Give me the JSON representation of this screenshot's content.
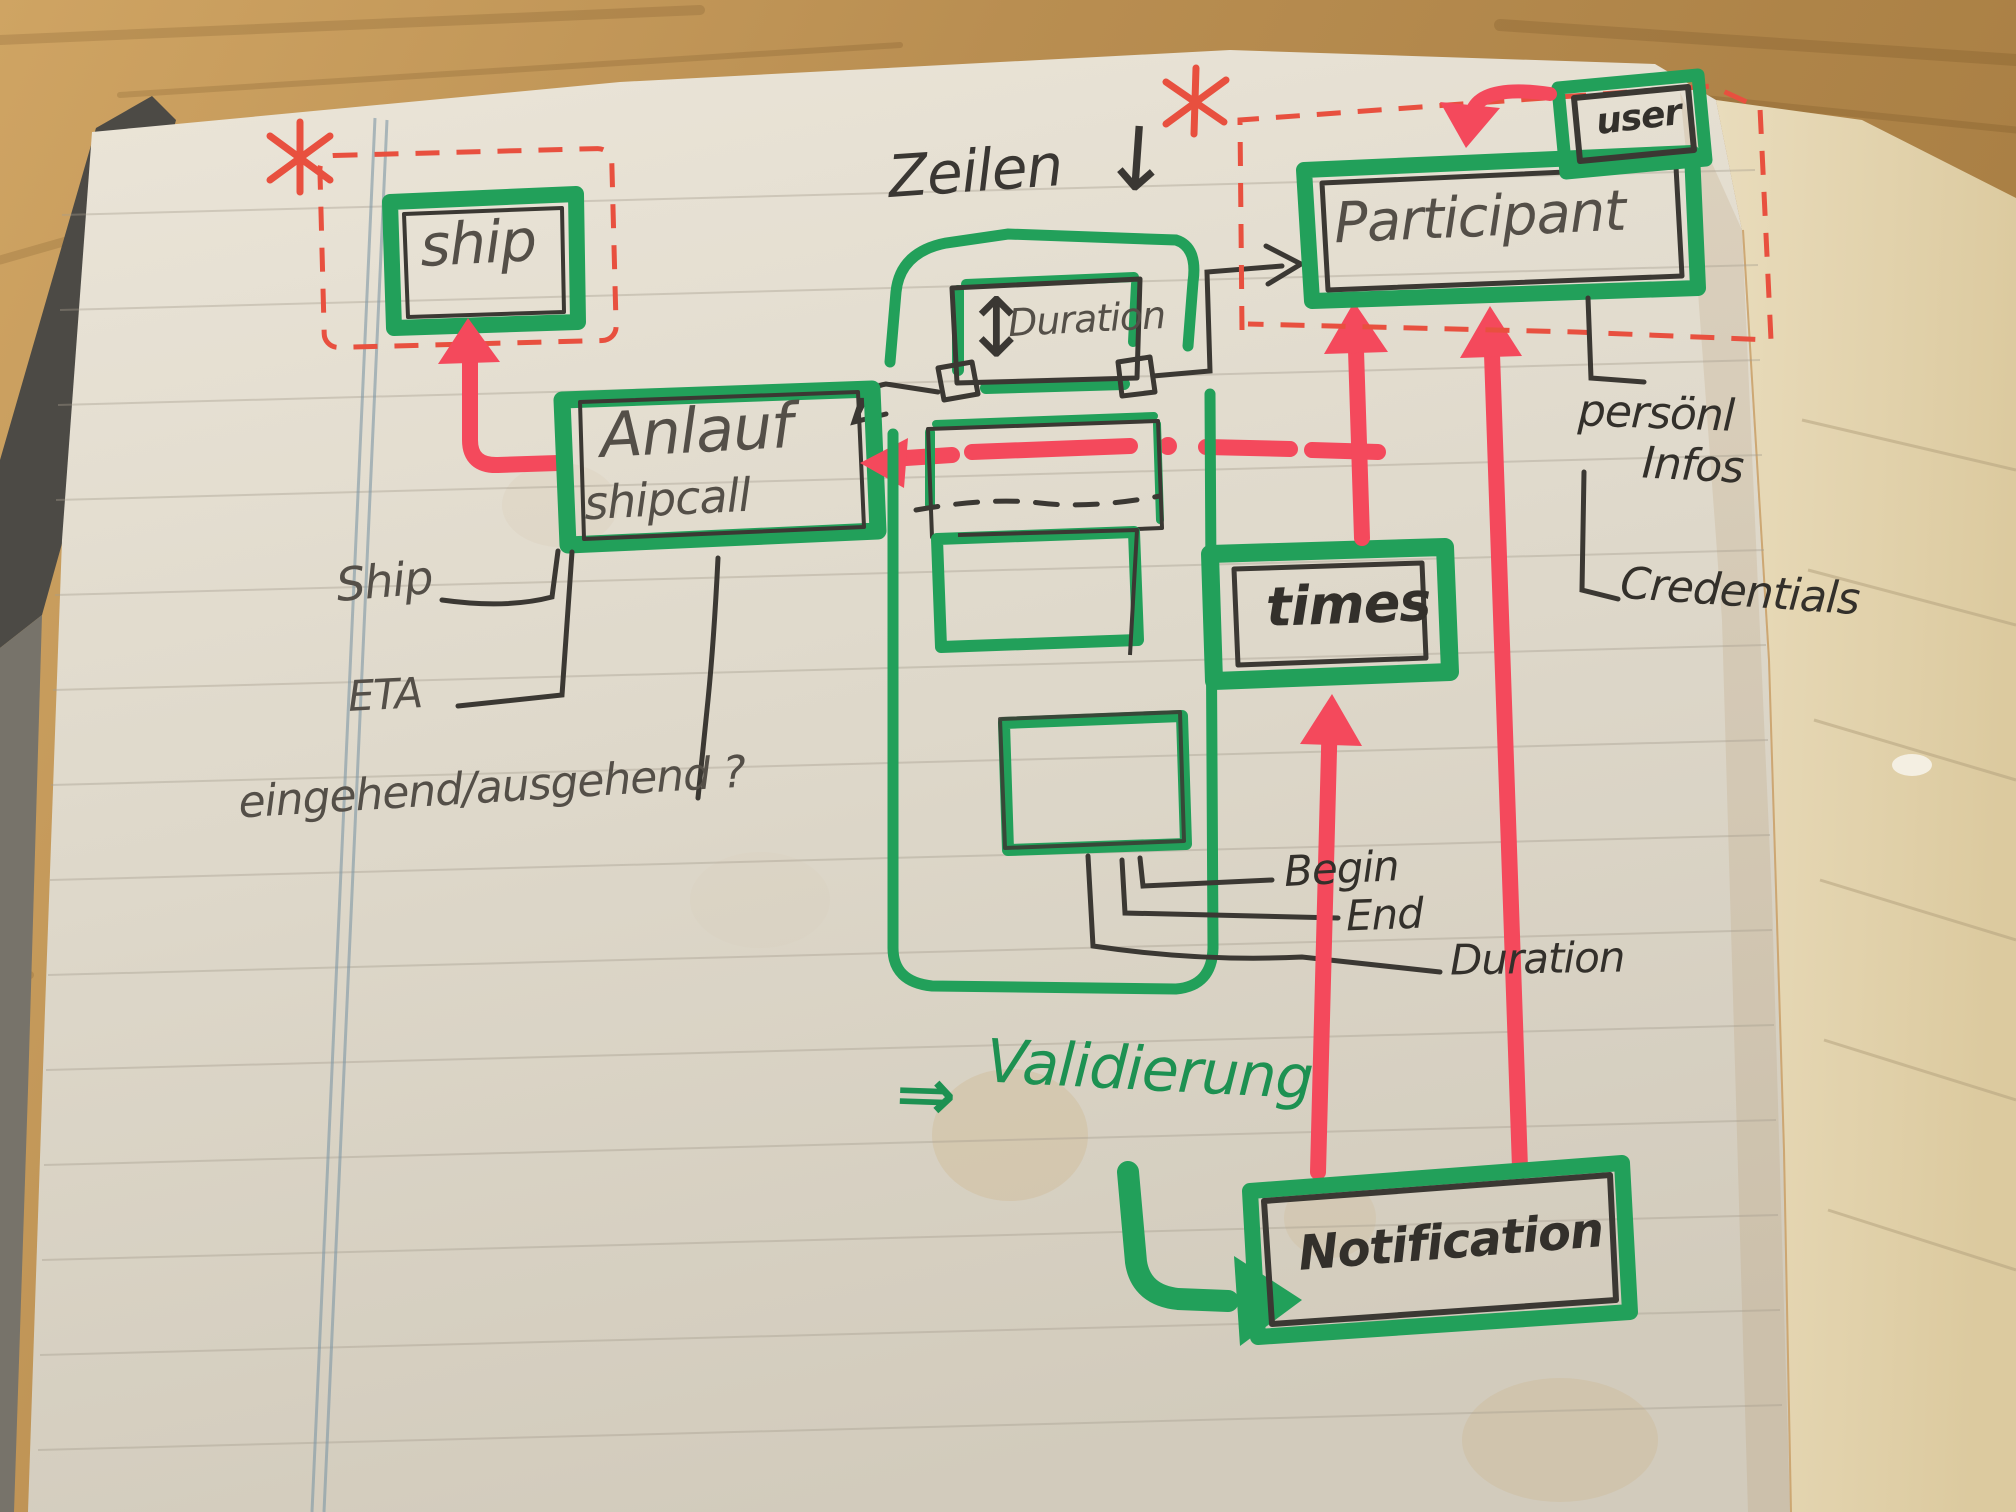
{
  "boxes": {
    "ship": "ship",
    "anlauf": "Anlauf",
    "shipcall": "shipcall",
    "participant": "Participant",
    "user": "user",
    "times": "times",
    "notification": "Notification",
    "duration_box": "Duration"
  },
  "annotations": {
    "zeilen": "Zeilen",
    "zeilen_arrow": "↓",
    "updown_arrow": "↕",
    "validierung_arrow": "⇒",
    "validierung": "Validierung"
  },
  "attributes": {
    "ship": "Ship",
    "eta": "ETA",
    "inout": "eingehend/ausgehend ?",
    "begin": "Begin",
    "end": "End",
    "duration": "Duration",
    "personal_line1": "persönl",
    "personal_line2": "Infos",
    "credentials": "Credentials"
  },
  "colors": {
    "marker_green": "#22a05a",
    "marker_red": "#f4495c",
    "pen_red_dashed": "#e8503f",
    "ink": "#33302b",
    "pencil": "#544f48",
    "paper": "#e2dccd",
    "wood": "#b98e51"
  }
}
